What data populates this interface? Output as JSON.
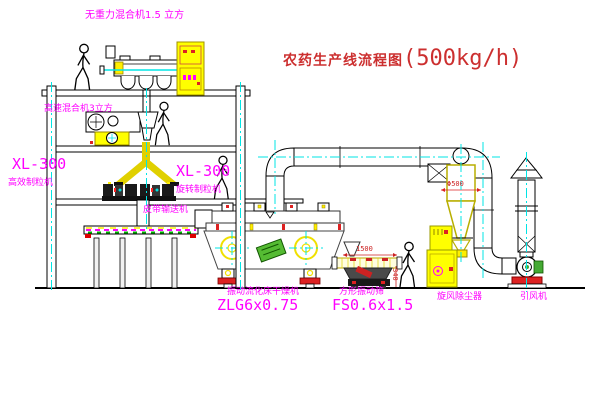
{
  "title": {
    "name_cn": "农药生产线流程图",
    "capacity": "(500kg/h)"
  },
  "labels": {
    "top_mixer": "无重力混合机1.5 立方",
    "second_mixer": "高速混合机3立方",
    "granulator_left_model": "XL-300",
    "granulator_left": "高效制粒机",
    "granulator_right_model": "XL-300",
    "granulator_right": "旋转制粒机",
    "belt_conveyor": "皮带输送机",
    "dryer": "振动流化床干燥机",
    "dryer_model": "ZLG6x0.75",
    "screen": "方形振动筛",
    "screen_model": "FS0.6x1.5",
    "cyclone": "旋风除尘器",
    "fan": "引风机"
  },
  "dimensions": {
    "cyclone_diameter": "Φ500",
    "screen_length": "1500",
    "screen_height": "340"
  },
  "colors": {
    "equipment_yellow": "#f0e000",
    "label_magenta": "#ff00ff",
    "centerline_cyan": "#00e5e5",
    "title_red": "#cc2f2f",
    "accent_red": "#dd2222",
    "line_black": "#000000",
    "accent_green": "#44aa33"
  }
}
